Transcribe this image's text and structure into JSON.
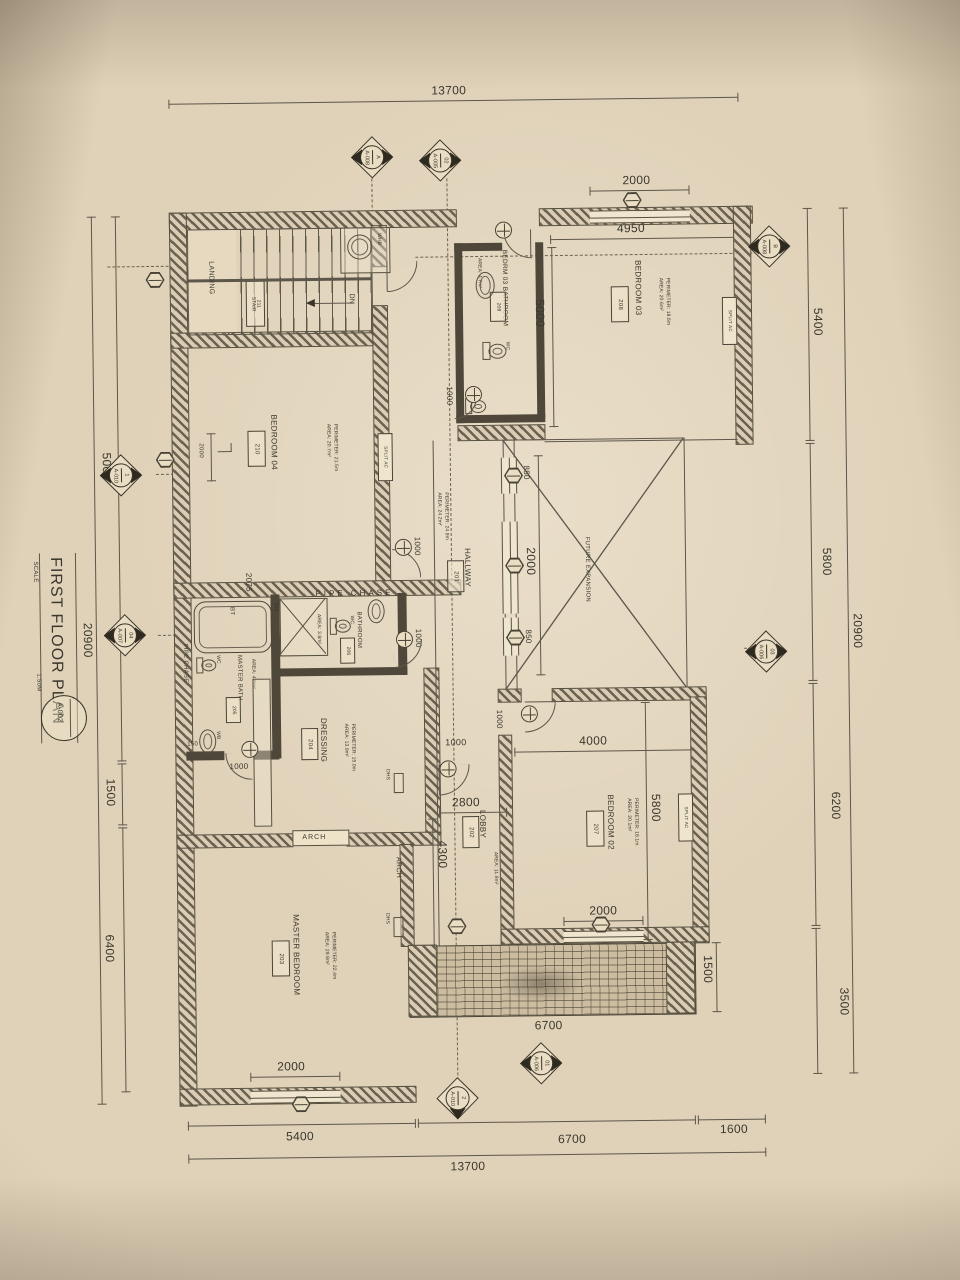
{
  "title_block": {
    "title": "FIRST FLOOR PLAN",
    "scale_label": "SCALE",
    "scale_value": "1:50M",
    "sheet_no": "A-002"
  },
  "dims": {
    "top_total": "13700",
    "bottom_total": "13700",
    "k2000": "2000",
    "bed03_w": "4950",
    "bath209_h": "5000",
    "r1": "5400",
    "r2": "5800",
    "r3": "6200",
    "r4": "3500",
    "r_total": "20900",
    "l1": "5000",
    "l2": "1500",
    "l3": "6400",
    "l_total": "20900",
    "b1": "5400",
    "b2": "6700",
    "b3": "1600",
    "k850": "850",
    "k1000": "1000",
    "pipe_w": "2075",
    "lobby_w": "2800",
    "lobby_h": "4300",
    "bed02_w": "4000",
    "bed02_h": "5800",
    "balcony_l": "6700",
    "balcony_w": "1500",
    "k150": "150"
  },
  "rooms": {
    "bedroom03": {
      "name": "BEDROOM 03",
      "tag": "208",
      "area": "AREA: 20.6m²",
      "perim": "PERIMETER: 18.6m"
    },
    "bedroom04": {
      "name": "BEDROOM 04",
      "tag": "210",
      "area": "AREA: 20.7m²",
      "perim": "PERIMETER: 21.5m"
    },
    "bedroom02": {
      "name": "BEDROOM 02",
      "tag": "207",
      "area": "AREA: 20.1m²",
      "perim": "PERIMETER: 18.1m"
    },
    "master_bedroom": {
      "name": "MASTER BEDROOM",
      "tag": "203",
      "area": "AREA: 29.8m²",
      "perim": "PERIMETER: 22.4m"
    },
    "hallway": {
      "name": "HALLWAY",
      "tag": "201",
      "area": "AREA: 24.2m²",
      "perim": "PERIMETER: 24.9m"
    },
    "lobby": {
      "name": "LOBBY",
      "tag": "202",
      "area": "AREA: 11.9m²",
      "perim": "PERIMETER: 13.8m"
    },
    "dressing": {
      "name": "DRESSING",
      "tag": "204",
      "area": "AREA: 13.9m²",
      "perim": "PERIMETER: 15.0m"
    },
    "master_bath": {
      "name": "MASTER BATH",
      "tag": "205",
      "area": "AREA: 4.6m²",
      "perim": "PERIM: 8.6m"
    },
    "bathroom": {
      "name": "BATHROOM",
      "tag": "206",
      "area": "AREA: 3.8m²",
      "perim": "PERIM: 8.0m"
    },
    "bed03_bath": {
      "name": "BEDRM 03 BATHROOM",
      "tag": "209",
      "area": "AREA: 4.7m²",
      "perim": "PERIM: 8.7m"
    },
    "stair": {
      "name": "STAIR",
      "tag": "211"
    },
    "landing": {
      "name": "LANDING"
    },
    "future": {
      "name": "FUTURE EXPANSION"
    }
  },
  "labels": {
    "dn": "DN",
    "whb": "WHB",
    "bt": "BT",
    "sh": "SH",
    "wc": "WC",
    "wb": "WB",
    "dhs": "DHS",
    "pipe_chase": "PIPE CHASE",
    "arch": "ARCH",
    "split_ac": "SPLIT AC"
  },
  "markers": [
    {
      "num": "A",
      "sheet": "A-008"
    },
    {
      "num": "02",
      "sheet": "A-005"
    },
    {
      "num": "B",
      "sheet": "A-008"
    },
    {
      "num": "1",
      "sheet": "A-010"
    },
    {
      "num": "04",
      "sheet": "A-007"
    },
    {
      "num": "03",
      "sheet": "A-006"
    },
    {
      "num": "01",
      "sheet": "A-006"
    },
    {
      "num": "2",
      "sheet": "A-010"
    }
  ]
}
